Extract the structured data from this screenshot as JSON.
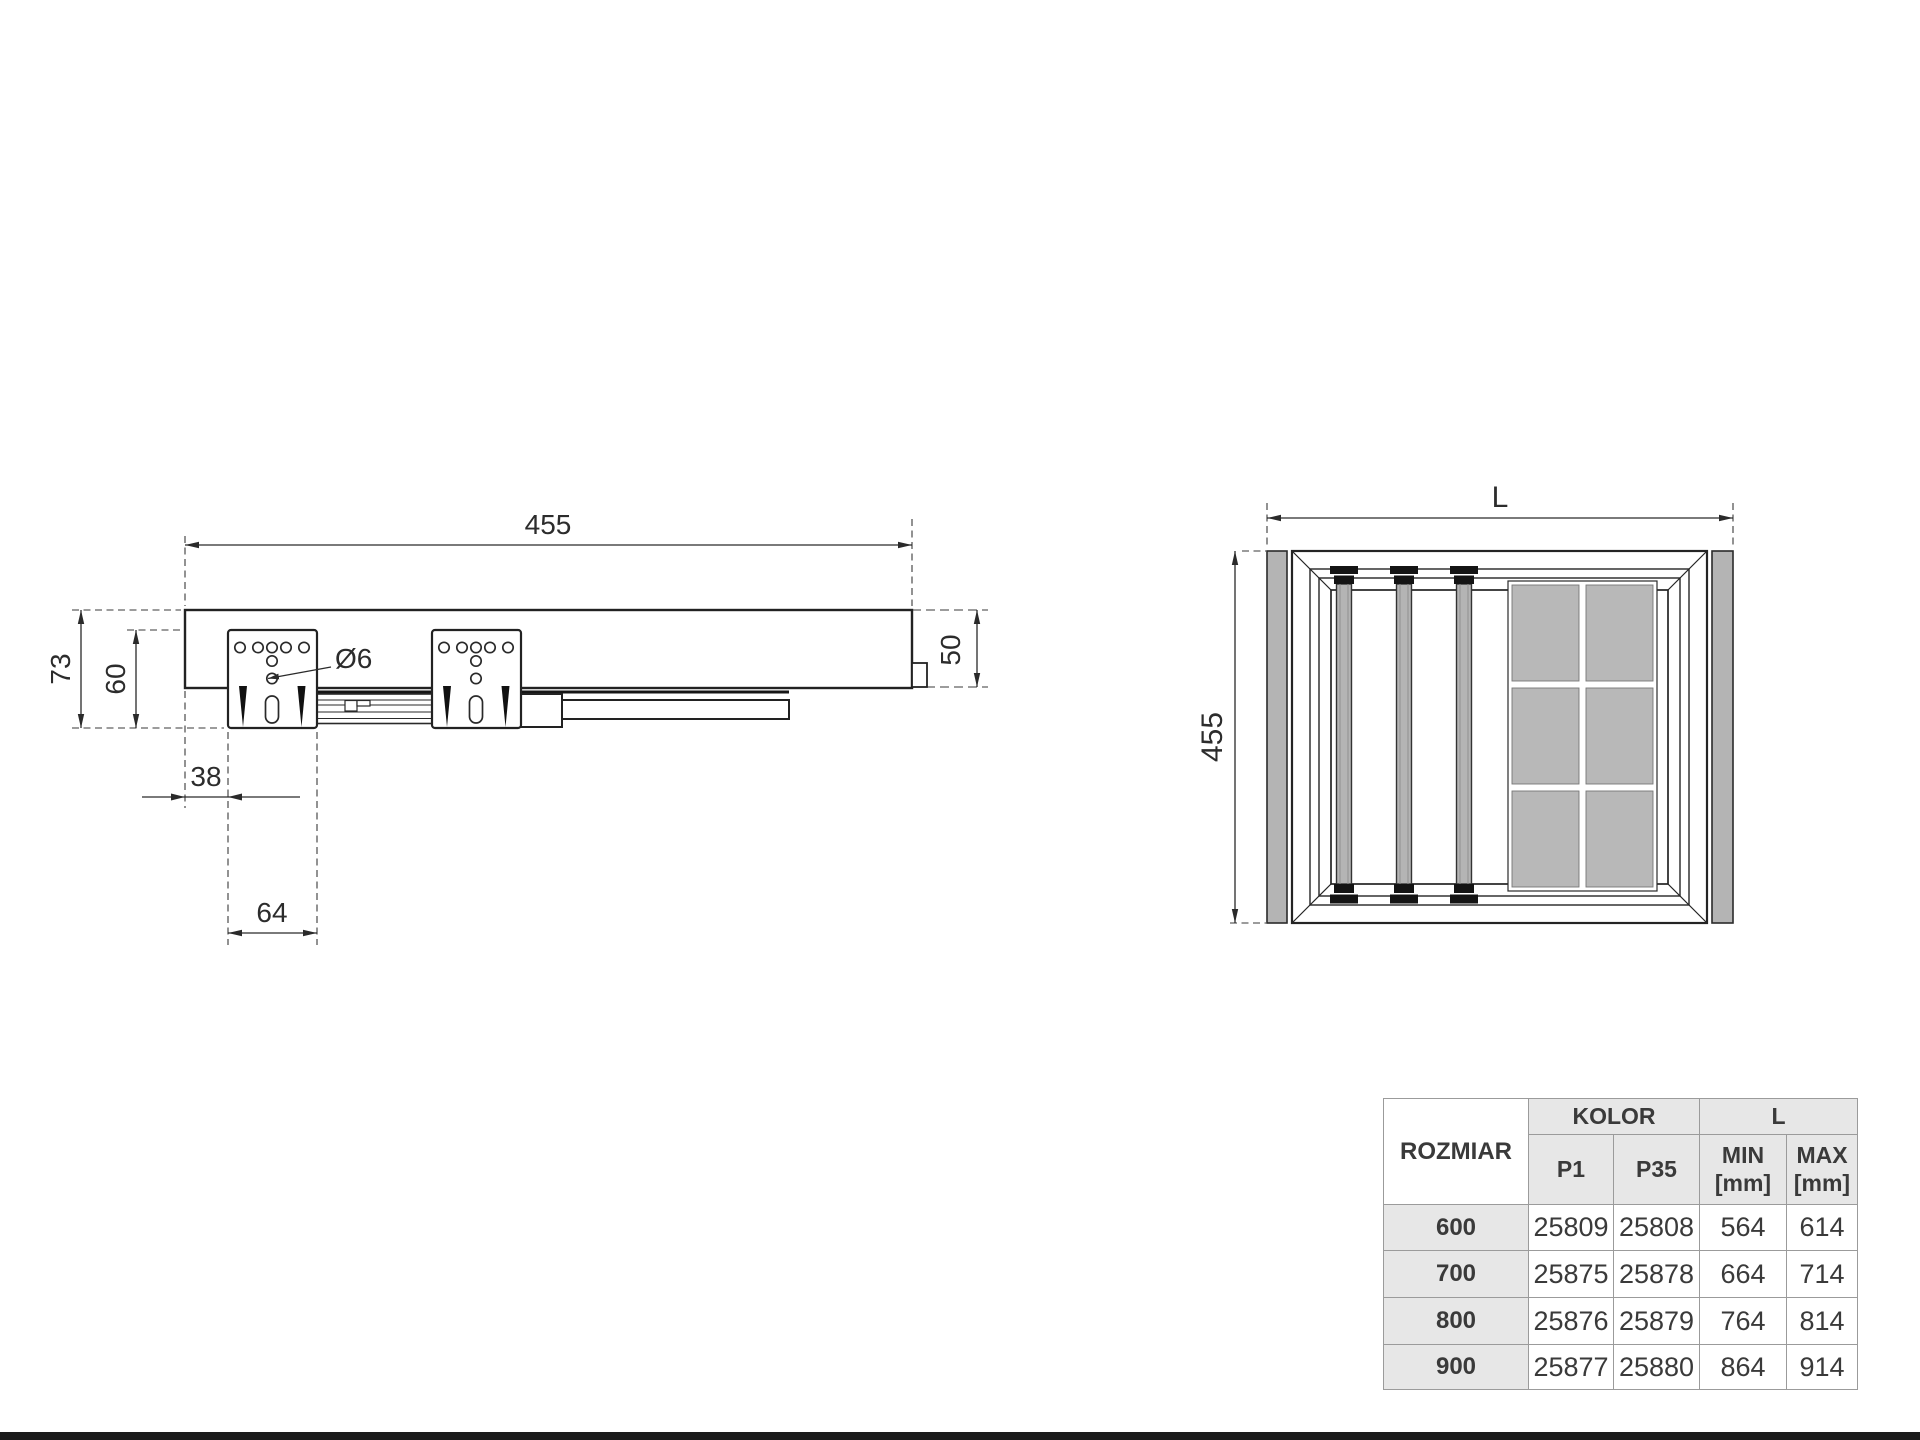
{
  "side_view": {
    "dim_width": "455",
    "dim_height_total": "73",
    "dim_height_bracket": "60",
    "dim_front_offset": "38",
    "dim_bracket_spacing": "64",
    "dim_hole_diameter": "Ø6",
    "dim_rear_height": "50"
  },
  "top_view": {
    "dim_length": "L",
    "dim_depth": "455"
  },
  "table": {
    "col_rozmiar": "ROZMIAR",
    "group_kolor": "KOLOR",
    "group_l": "L",
    "col_p1": "P1",
    "col_p35": "P35",
    "col_min": "MIN",
    "col_max": "MAX",
    "unit": "[mm]",
    "rows": [
      {
        "rozmiar": "600",
        "p1": "25809",
        "p35": "25808",
        "min": "564",
        "max": "614"
      },
      {
        "rozmiar": "700",
        "p1": "25875",
        "p35": "25878",
        "min": "664",
        "max": "714"
      },
      {
        "rozmiar": "800",
        "p1": "25876",
        "p35": "25879",
        "min": "764",
        "max": "814"
      },
      {
        "rozmiar": "900",
        "p1": "25877",
        "p35": "25880",
        "min": "864",
        "max": "914"
      }
    ]
  },
  "colors": {
    "line": "#2a2a2a",
    "gray_fill": "#b4b4b4",
    "table_header_bg": "#e7e7e7",
    "table_border": "#9b9b9b"
  }
}
